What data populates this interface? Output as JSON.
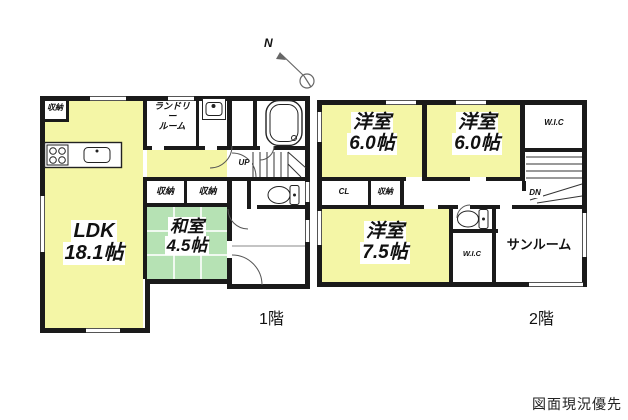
{
  "page": {
    "disclaimer": "図面現況優先"
  },
  "compass": {
    "label": "N"
  },
  "floor1": {
    "label": "1階",
    "ldk": {
      "name": "LDK",
      "area": "18.1帖"
    },
    "washitsu": {
      "name": "和室",
      "area": "4.5帖"
    },
    "laundry": {
      "line1": "ランドリー",
      "line2": "ルーム"
    },
    "closet_top_left": "収納",
    "closet_left": "収納",
    "closet_right": "収納",
    "stairs_label": "UP"
  },
  "floor2": {
    "label": "2階",
    "bedroom1": {
      "name": "洋室",
      "area": "6.0帖"
    },
    "bedroom2": {
      "name": "洋室",
      "area": "6.0帖"
    },
    "bedroom3": {
      "name": "洋室",
      "area": "7.5帖"
    },
    "wic_top": "W.I.C",
    "wic_bottom": "W.I.C",
    "closet_cl": "CL",
    "closet": "収納",
    "sunroom": "サンルーム",
    "stairs_label": "DN"
  },
  "colors": {
    "floor_yellow": "#f4f6a6",
    "tatami_green": "#b6e2b4",
    "wall_black": "#1a1a1a"
  }
}
